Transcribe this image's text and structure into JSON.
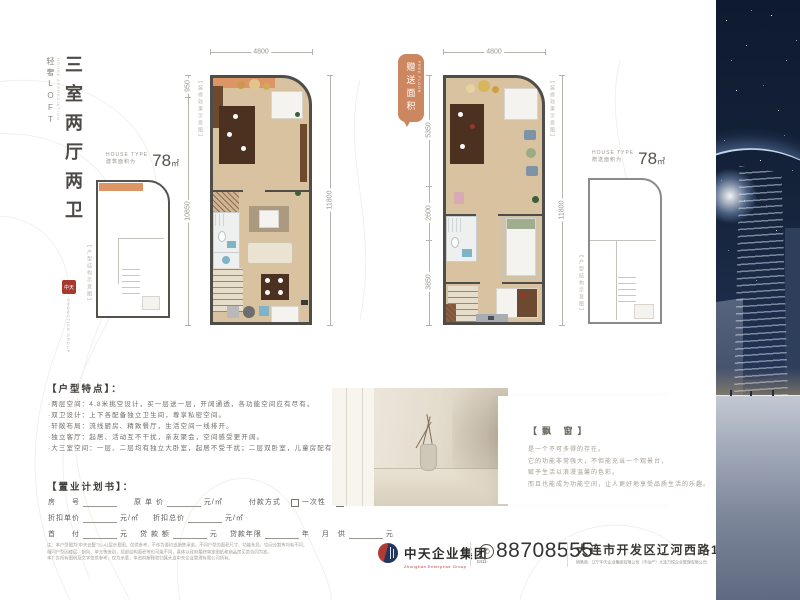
{
  "brand": {
    "loft": "轻奢LOFT",
    "loft_en": "HOUSE APPRECIATION",
    "title": "三室两厅两卫",
    "seal_text": "中天",
    "group_en": "ZHONGTIAN GROUP"
  },
  "plan_small_left": {
    "house_type": "HOUSE TYPE",
    "area_label": "建筑面积为",
    "area_value": "78",
    "area_unit": "㎡",
    "note": "【户型结构示意图】",
    "dim_top": "950",
    "dim_bottom": "10850"
  },
  "plan_main_left": {
    "dim_top": "4800",
    "dim_right": "11800",
    "note": "【装修效果示意图】"
  },
  "plan_main_right": {
    "dim_top": "4800",
    "dim_right": "11800",
    "note": "【装修效果示意图】",
    "dim_left_1": "5350",
    "dim_left_2": "2600",
    "dim_left_3": "3850",
    "tag": "赠送面积",
    "tag_en": "FREE FLOOR"
  },
  "plan_small_right": {
    "house_type": "HOUSE TYPE",
    "area_label": "赠送面积为",
    "area_value": "78",
    "area_unit": "㎡",
    "note": "【户型结构示意图】"
  },
  "features": {
    "heading": "【户型特点】：",
    "items": [
      "·两层空间：4.8米挑空设计，买一层送一层，开阔通透，各功能空间应有尽有。",
      "·双卫设计：上下各配备独立卫生间，尊享私密空间。",
      "·轩敞布局：流线厨房、精致餐厅，生活空间一线排开。",
      "·独立客厅：起居、活动互不干扰，亲友聚会，空间感受更开阔。",
      "·大三室空间：一层、二层均有独立大卧室，起居不受干扰；二层双卧室，儿童房配有书桌设计，学习环境更舒适。"
    ]
  },
  "purchase": {
    "heading": "【置业计划书】：",
    "room_label": "房　　号",
    "orig_label": "原 单 价",
    "orig_unit": "元/㎡",
    "pay_label": "付款方式",
    "pay_opt1": "一次性",
    "pay_opt2": "商业贷",
    "disc_unit_label": "折扣单价",
    "disc_unit_unit": "元/㎡",
    "disc_total_label": "折扣总价",
    "disc_total_unit": "元/㎡",
    "down_label": "首　　付",
    "down_unit": "元",
    "loan_label": "贷 款 额",
    "loan_unit": "元",
    "years_label": "贷款年限",
    "years_unit": "年",
    "monthly_label": "月　供",
    "monthly_unit": "元"
  },
  "bay": {
    "heading": "【飘 窗】",
    "lines": [
      "是一个不可多得的存在。",
      "它的功能非常强大，不但能充当一个观景台，",
      "赋予生活以浪漫温馨的色彩。",
      "而且也能成为功能空间，让人更好地享受品质生活的乐趣。"
    ]
  },
  "disclaimer": [
    "注：本户型图为“中天云墅”31-41层示意图，仅供参考，不作为要约或销售承诺。不同户型的面积尺寸、功能布局、空间分割等均有不同，",
    "相同户型因楼层、朝向、单元等差别，局部结构面积等也可能不同，具体以政府最终审定图纸和商品房买卖合同为准。",
    "本广告所有图例及文字仅供参考，仅为示意，本资料解释权归属大连中天企业管理有限公司所有。"
  ],
  "footer": {
    "company": "中天企业集团",
    "company_en": "Zhongtian Enterprise Group",
    "phone_icon": "✆",
    "area_code": "0411·",
    "phone": "88708555",
    "address": "大连市开发区辽河西路117号",
    "address_sub": "销售商：辽宁中天企业集团有限公司（不动产）大连万悦企业管理有限公司"
  },
  "colors": {
    "accent_orange": "#cd8760",
    "logo_red": "#b23a34",
    "logo_navy": "#22365e",
    "night_sky": "#142239",
    "plan_floor": "#d9c29f"
  }
}
